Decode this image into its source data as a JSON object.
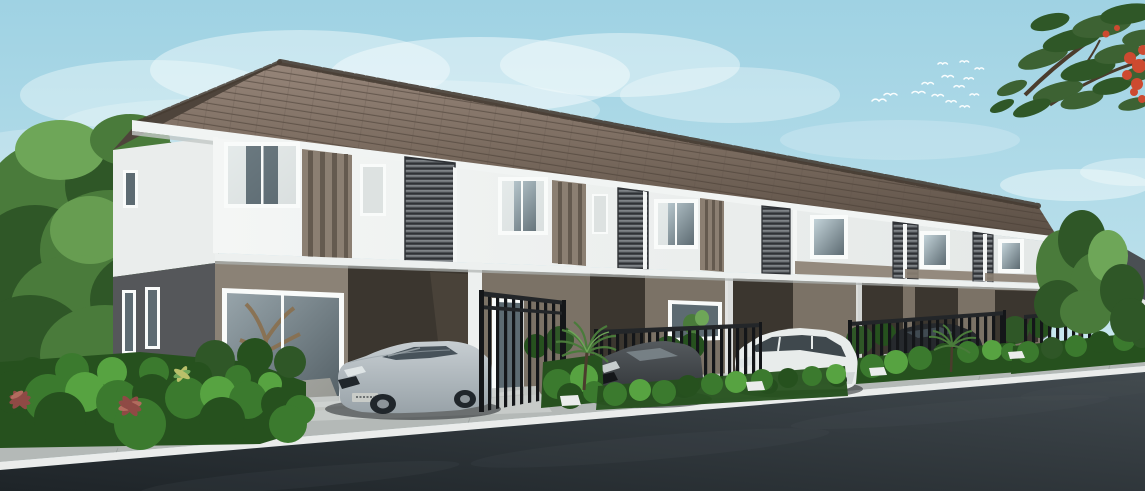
{
  "scene": {
    "type": "architectural-rendering",
    "subject": "two-story-townhouse-row",
    "units_visible": 6,
    "cars": [
      {
        "name": "silver-sedan",
        "color_ref": "car_silver_hi"
      },
      {
        "name": "dark-grey-hatchback",
        "color_ref": "dark_car_hi"
      },
      {
        "name": "white-minivan",
        "color_ref": "van_white"
      },
      {
        "name": "dark-car-behind-fence",
        "color_ref": "bg_car"
      },
      {
        "name": "distant-white-car",
        "color_ref": "van_white"
      }
    ],
    "landscape": [
      "left-tree",
      "flame-tree-branch",
      "front-hedges",
      "fan-palms",
      "red-cordyline-plants",
      "background-trees"
    ],
    "sky_features": [
      "soft-clouds",
      "bird-flock"
    ]
  },
  "palette": {
    "sky_top": "#9fd2e3",
    "sky_mid": "#b7deea",
    "sky_horizon": "#d6edf2",
    "cloud": "#f6fcfd",
    "bird": "#fdffff",
    "roof_light": "#97867a",
    "roof_mid": "#7a6b5f",
    "roof_dark": "#5a4e44",
    "roof_hip": "#4e443b",
    "roof_ridge": "#463c33",
    "roof_edge": "#3a322b",
    "fascia": "#f1f4f3",
    "fascia_shadow": "#c3c8c7",
    "wall_white": "#f4f6f5",
    "wall_shade": "#e4e8e7",
    "accent_taupe": "#8b7f72",
    "accent_stripe": "#645a4f",
    "louver_mid": "#5d6165",
    "louver_dark": "#3f4347",
    "louver_light": "#8b9094",
    "louver_frame": "#2f3236",
    "window_frame": "#f9fbfa",
    "glass_light": "#c3d3d9",
    "glass_dark": "#5d6b72",
    "glass2_hi": "#97a4aa",
    "glass2_lo": "#525e64",
    "curtain": "#e8eceb",
    "frosted": "#dde2e1",
    "slab_white": "#edf0ef",
    "slab_shadow": "#aeb2b0",
    "ground_taupe": "#8b8276",
    "ground_mid": "#7b7266",
    "carport_dark": "#3b362f",
    "carport_inner": "#554c42",
    "floor": "#9d968b",
    "side_upper": "#eaedec",
    "side_lower": "#55575a",
    "reflect_brown": "#8a6f4e",
    "reflect_light": "#cfc8ba",
    "fence_black": "#141619",
    "fence_rail": "#232629",
    "hedge": "#3b7a2e",
    "hedge_light": "#57a341",
    "hedge_dark": "#26511e",
    "grass": "#4c7c3a",
    "tree_green": "#4a7b3b",
    "tree_dark": "#2f5727",
    "tree_light": "#6ea658",
    "trunk": "#4b3c2d",
    "flame_leaf": "#3d6233",
    "flame_red": "#cd4a30",
    "red_plant": "#8f4a45",
    "red_plant_light": "#b26b5e",
    "variegated": "#b9c06a",
    "far_roof": "#4a4f53",
    "far_wall": "#e6e9e8",
    "walk": "#b4b9b7",
    "walk_light": "#c9cdcb",
    "curb": "#eaeceb",
    "joint": "#989e9c",
    "road_light": "#41494e",
    "road_dark": "#1e2428",
    "road_streak": "#4f585e",
    "car_silver_hi": "#c7ced2",
    "car_silver_lo": "#98a2a8",
    "car_glass": "#47525a",
    "car_trim": "#20262b",
    "plate": "#c9ccc8",
    "hub": "#8d959a",
    "dark_car_hi": "#555a5e",
    "dark_car_lo": "#2f3336",
    "dark_car_glass": "#7b858b",
    "van_white": "#e8eceb",
    "van_shade": "#b7bfc0",
    "van_glass": "#3f484d",
    "bg_car": "#26292d",
    "shadow": "#0f1418",
    "light_beam": "#dfe5e6"
  }
}
